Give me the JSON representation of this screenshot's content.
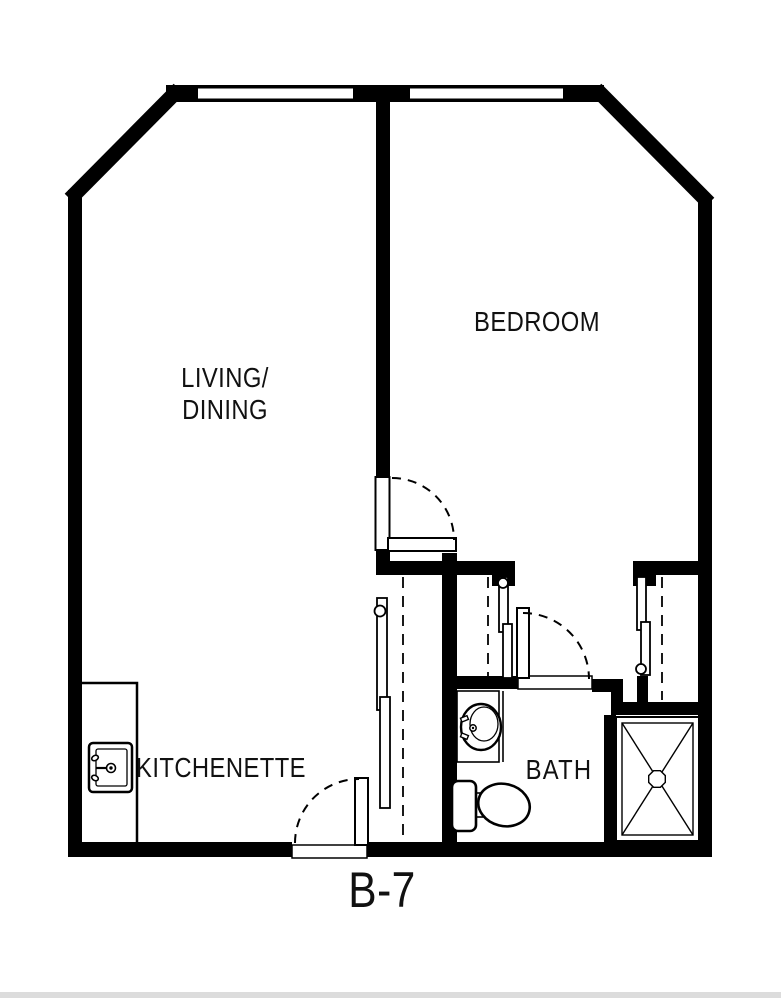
{
  "unit_label": "B-7",
  "rooms": {
    "living_dining": {
      "line1": "LIVING/",
      "line2": "DINING"
    },
    "bedroom": "BEDROOM",
    "kitchenette": "KITCHENETTE",
    "bath": "BATH"
  },
  "fixtures": [
    "kitchen-sink",
    "bath-sink",
    "toilet",
    "shower"
  ],
  "colors": {
    "wall": "#000000",
    "background": "#ffffff",
    "text": "#111111"
  }
}
